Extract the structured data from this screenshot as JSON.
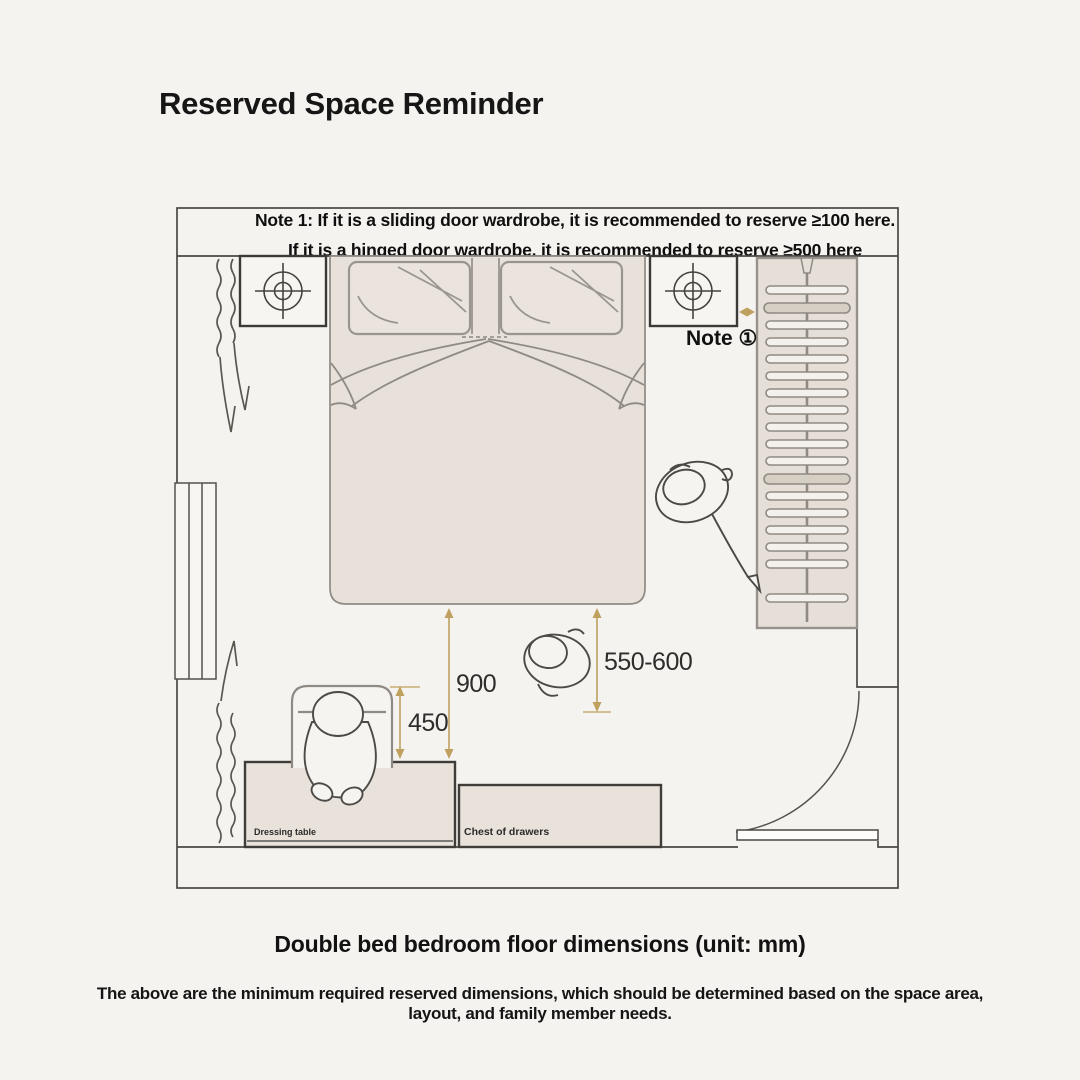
{
  "title": "Reserved Space Reminder",
  "notes": {
    "line1": "Note 1: If it is a sliding door wardrobe, it is recommended to reserve ≥100 here.",
    "line2": "If it is a hinged door wardrobe, it is recommended to reserve ≥500 here"
  },
  "plan": {
    "note_marker": "Note ①",
    "dimensions": {
      "bed_foot_clearance": "900",
      "chair_depth": "450",
      "bed_side_clearance": "550-600"
    },
    "furniture": {
      "dressing_table": "Dressing table",
      "chest_of_drawers": "Chest of drawers"
    },
    "colors": {
      "background": "#f5f3f0",
      "furniture_fill": "#e7e1da",
      "wall_line": "#4a4744",
      "sketch_line": "#8f8a83",
      "dimension_gold": "#bfa05e"
    }
  },
  "caption": "Double bed bedroom floor dimensions (unit: mm)",
  "footer": {
    "line1": "The above are the minimum required reserved dimensions, which should be determined based on the space area,",
    "line2": "layout, and family member needs."
  }
}
